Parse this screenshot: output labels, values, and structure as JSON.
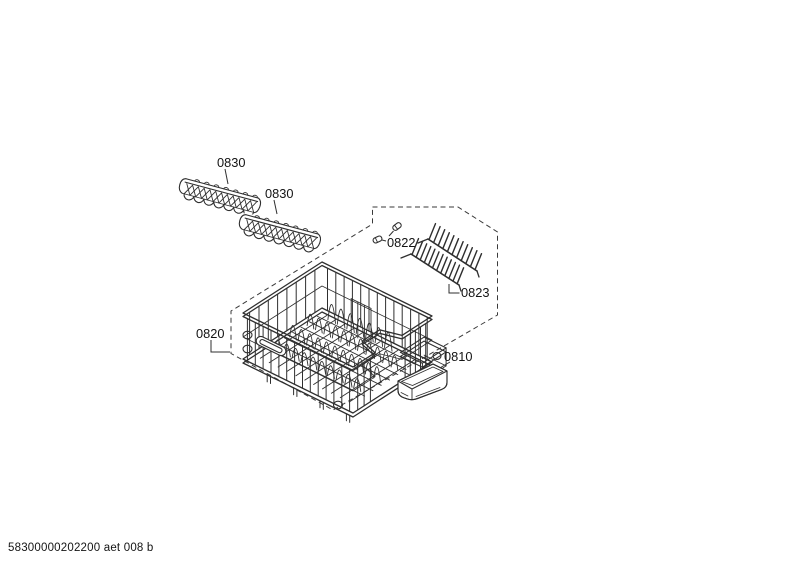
{
  "diagram": {
    "parts": {
      "rack_left": {
        "label": "0830"
      },
      "rack_right": {
        "label": "0830"
      },
      "clips": {
        "label": "0822"
      },
      "spike_rack": {
        "label": "0823"
      },
      "basket": {
        "label": "0820"
      },
      "tray": {
        "label": "0810"
      }
    }
  },
  "footer": {
    "code": "58300000202200 aet 008 b"
  },
  "colors": {
    "line": "#2f2f2f",
    "text": "#141414",
    "background": "#ffffff"
  }
}
